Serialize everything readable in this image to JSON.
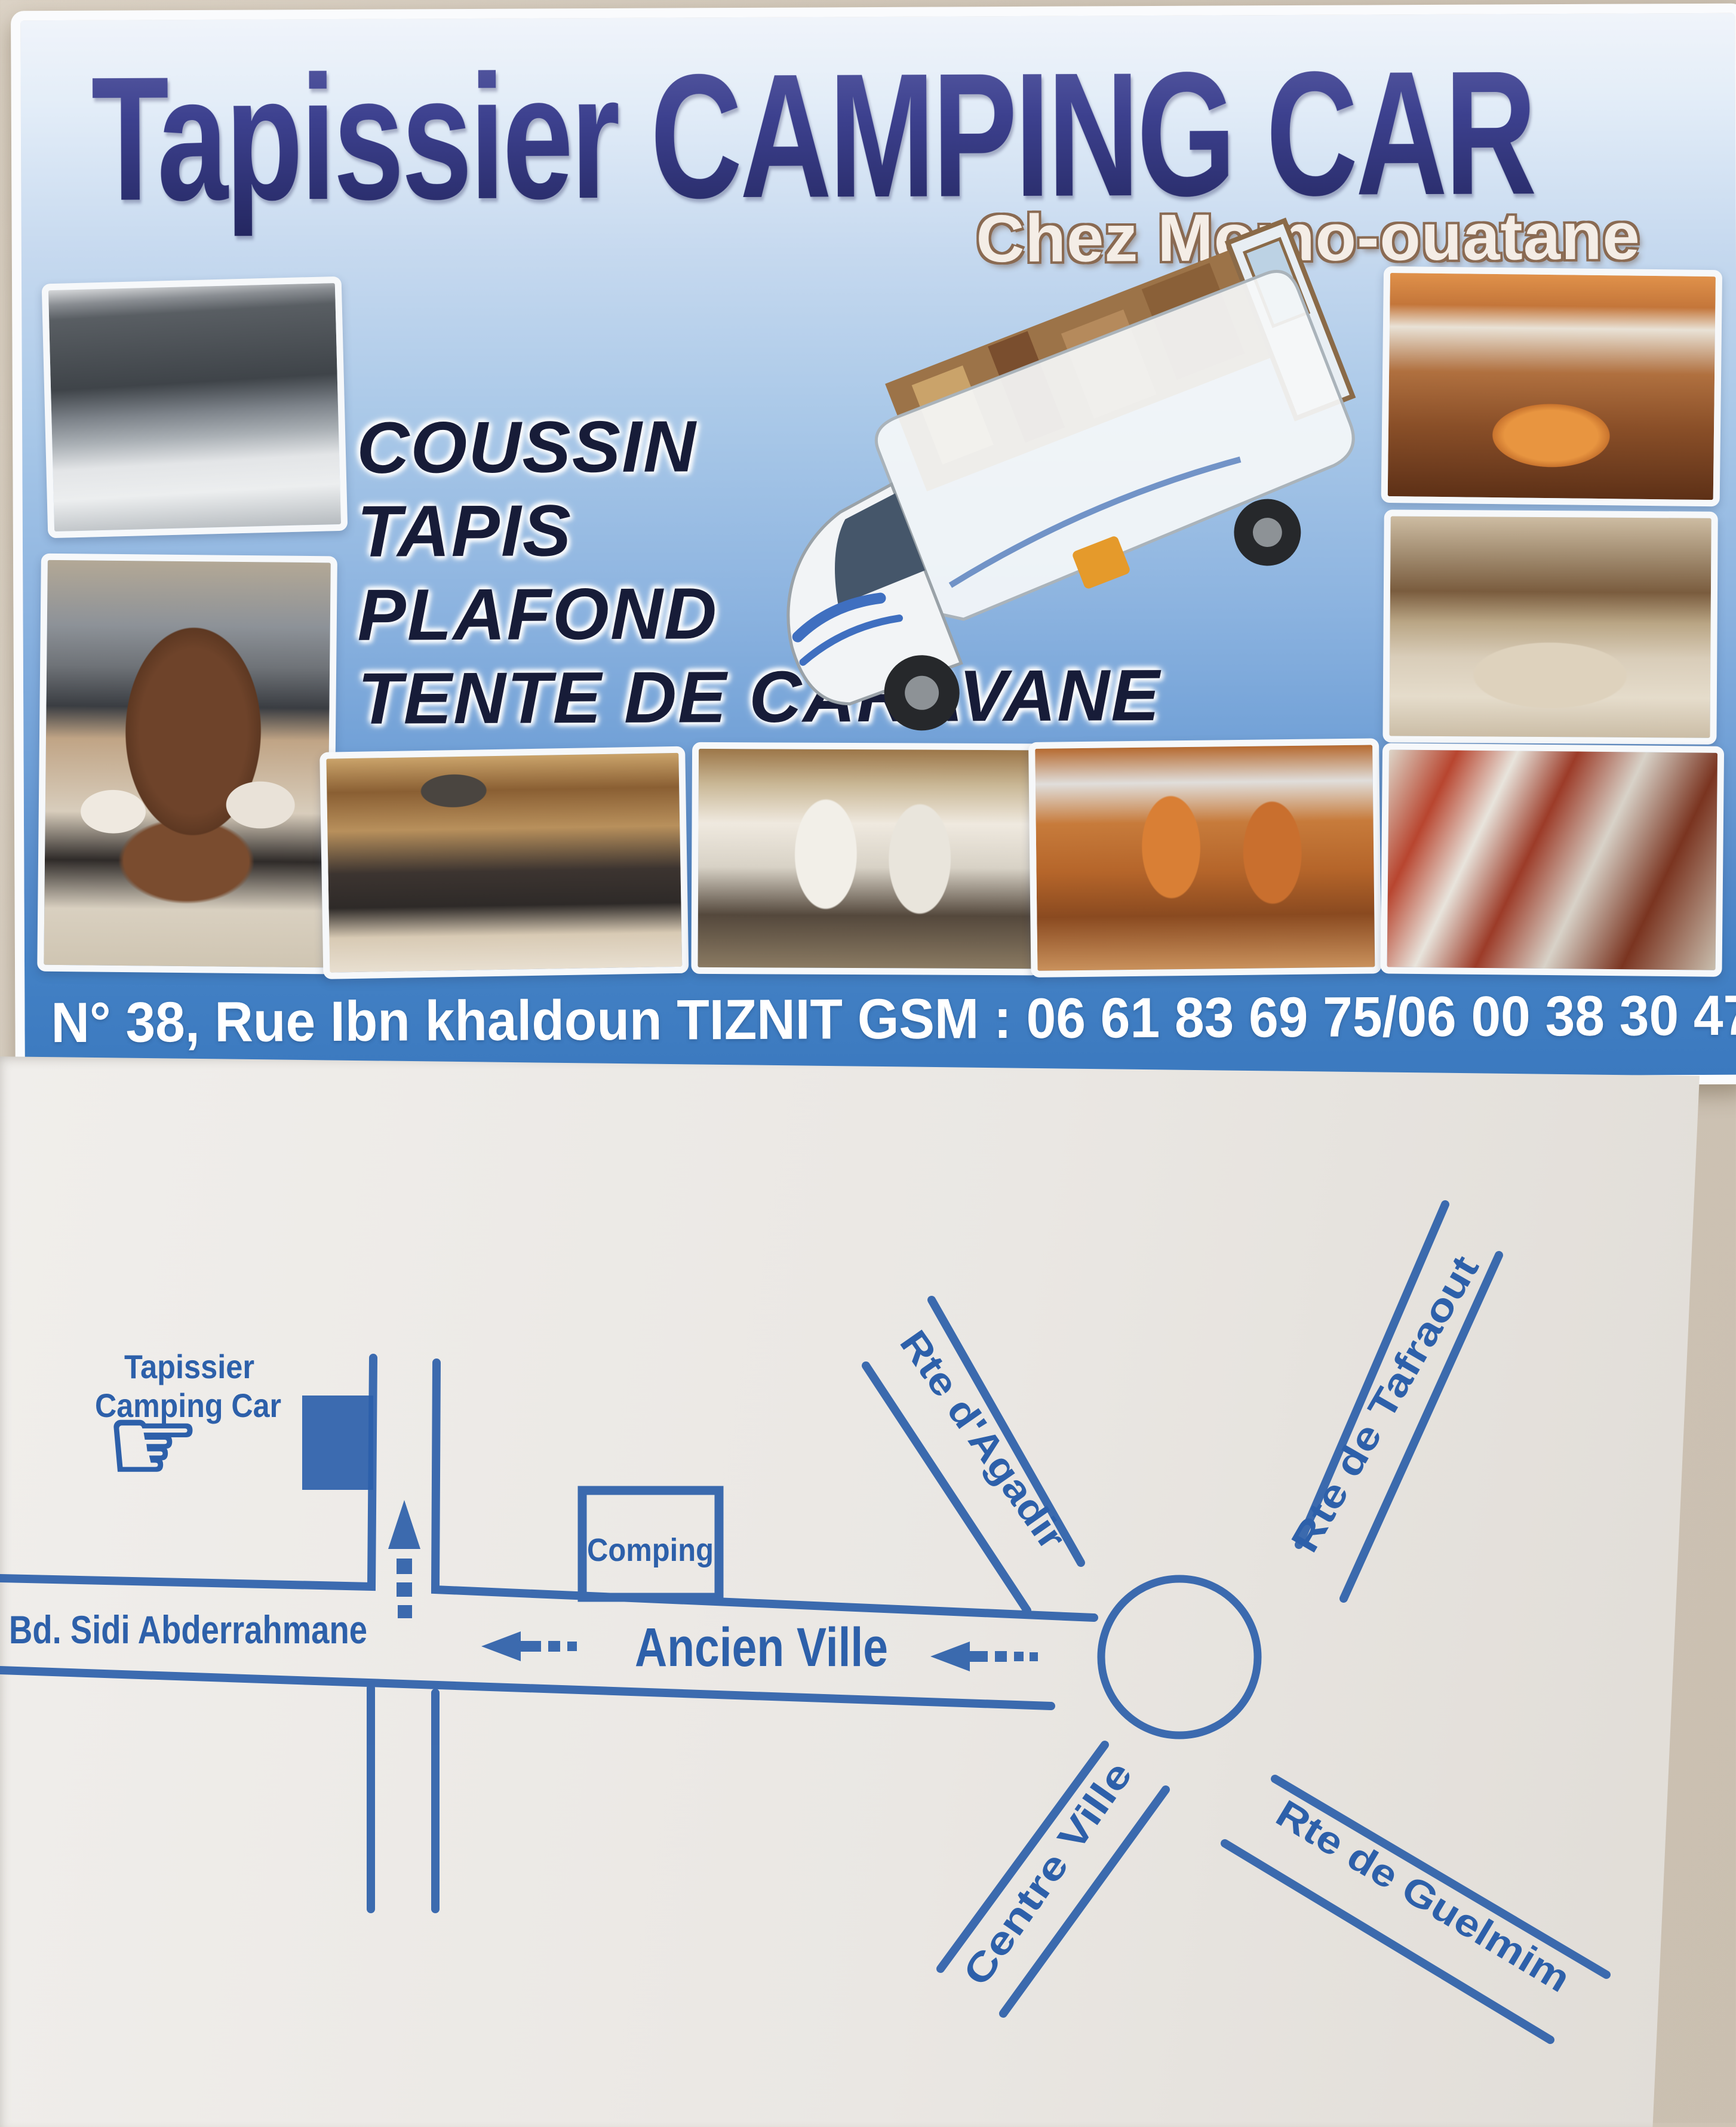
{
  "front": {
    "title": "Tapissier CAMPING CAR",
    "subtitle": "Chez Momo-ouatane",
    "services": [
      "COUSSIN",
      "TAPIS",
      "PLAFOND",
      "TENTE DE CARAVANE"
    ],
    "address": "N° 38, Rue Ibn khaldoun TIZNIT GSM : 06 61 83 69 75/06 00 38 30 47",
    "photos": [
      "camper van front",
      "captain seat",
      "dinette table interior",
      "overcab bed interior",
      "lounge interior",
      "cab seats interior",
      "orange seats interior",
      "kitchen interior"
    ]
  },
  "back": {
    "map": {
      "shop": {
        "line1": "Tapissier",
        "line2": "Camping Car"
      },
      "building_label": "Comping",
      "boulevard": "Bd. Sidi Abderrahmane",
      "main_street": "Ancien Ville",
      "roads": {
        "agadir": "Rte d'Agadir",
        "tafraout": "Rte de Tafraout",
        "guelmim": "Rte de Guelmim",
        "centre": "Centre Ville"
      }
    }
  },
  "colors": {
    "map_ink": "#2d60aa",
    "card_blue": "#3b79bf",
    "title_navy": "#34388a",
    "surface_beige": "#d2c8ba"
  }
}
